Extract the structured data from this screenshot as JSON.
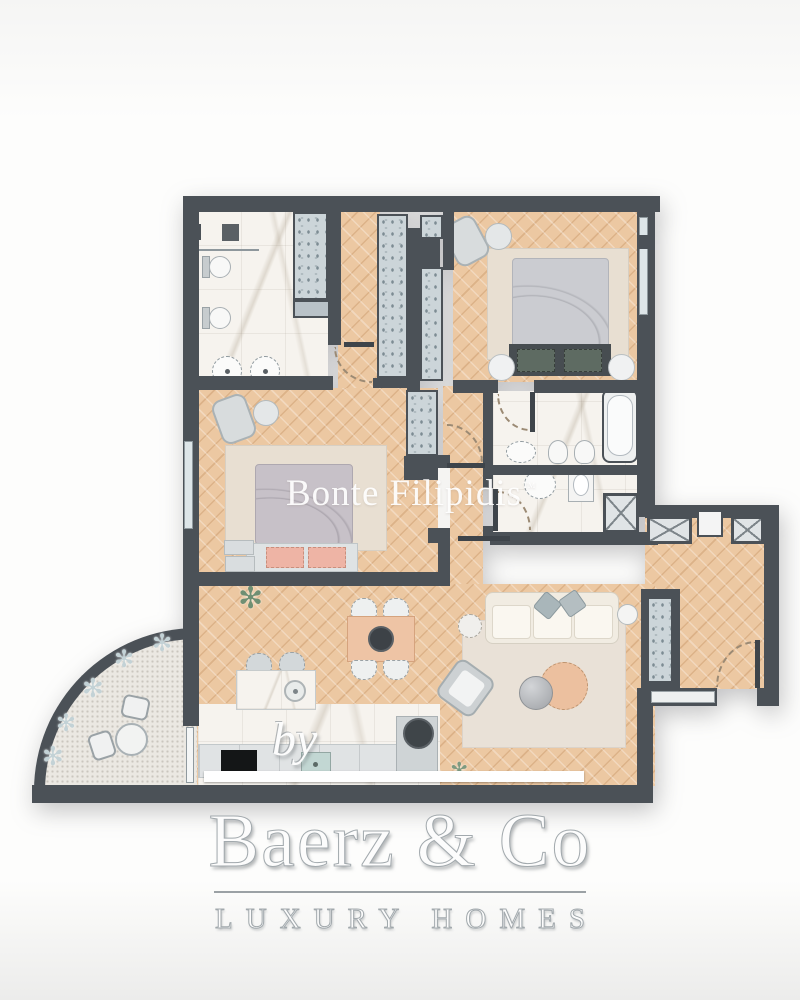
{
  "watermark": {
    "text": "Bonte Filipidis",
    "tm": "™"
  },
  "branding": {
    "byline": "by",
    "name": "Baerz & Co",
    "tagline": "LUXURY HOMES"
  },
  "icons": {
    "plant": "✻"
  },
  "palette": {
    "wall": "#4b5157",
    "wood_floor": "#ecc8a2",
    "marble_floor": "#f6f3ee",
    "wardrobe_fill": "#ccd5d9",
    "rug": "#e8dfd2",
    "sofa_cream": "#f1ece2",
    "accent_peach": "#ecc09f",
    "pillow_teal": "#5e6b62",
    "pillow_pink": "#eeb4a5",
    "duvet_grey": "#cbccd1",
    "gravel": "#ebe8e2",
    "cooktop_black": "#141617"
  },
  "rooms": [
    "master-bathroom",
    "walk-in-wardrobe",
    "bedroom-1",
    "bedroom-2",
    "bathroom-2",
    "shower-room",
    "entry-hall",
    "living-room",
    "kitchen-dining",
    "balcony"
  ]
}
